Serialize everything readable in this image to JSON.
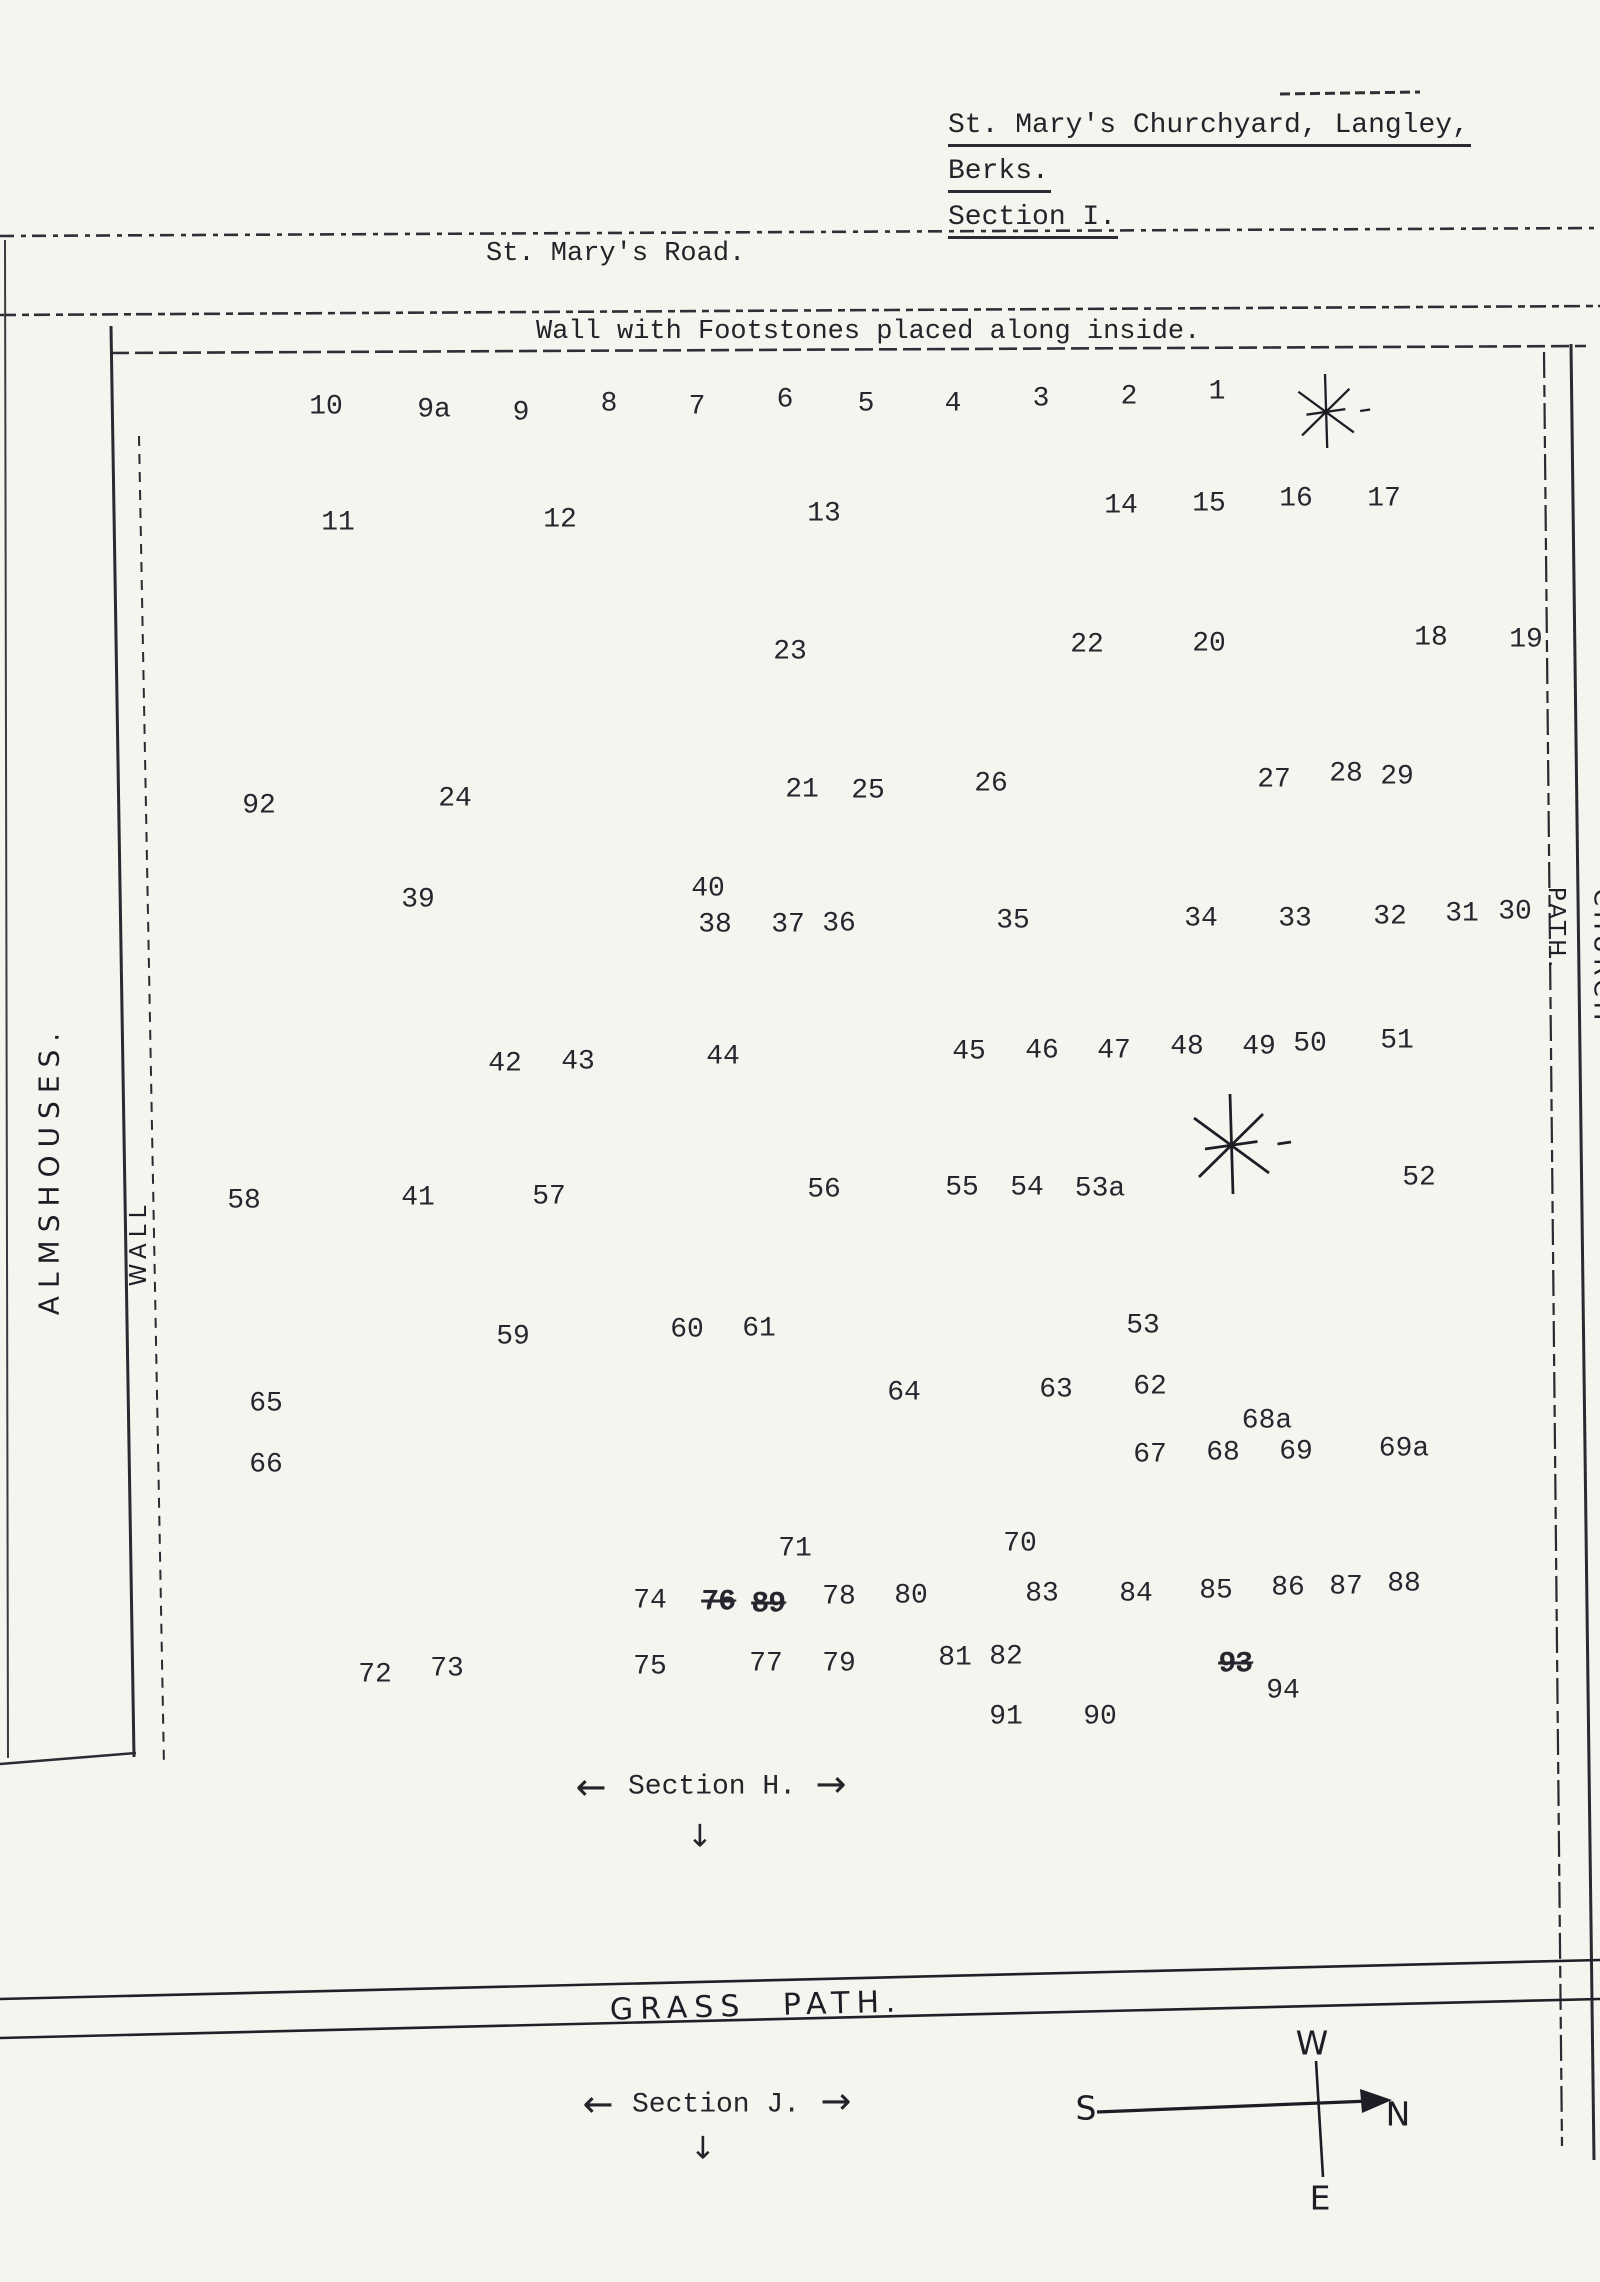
{
  "paper_color": "#f5f4ee",
  "ink_color": "#23232a",
  "title": {
    "lines": [
      "St. Mary's Churchyard, Langley,",
      "Berks.",
      "Section I."
    ]
  },
  "road_label": "St. Mary's Road.",
  "wall_label": "Wall with Footstones placed along inside.",
  "side_labels": {
    "almshouses": "ALMSHOUSES.",
    "wall": "WALL",
    "path": "PATH.",
    "church": "CHURCH"
  },
  "grass_path_label": "GRASS PATH.",
  "glyphs": {
    "arrow_left": "←",
    "arrow_right": "→",
    "arrow_down": "↓"
  },
  "sections": [
    {
      "label": "Section H.",
      "lx": 591,
      "ly": 1787,
      "cx": 712,
      "cy": 1787,
      "rx": 831,
      "ry": 1784,
      "dx": 700,
      "dy": 1837
    },
    {
      "label": "Section J.",
      "lx": 598,
      "ly": 2104,
      "cx": 716,
      "cy": 2105,
      "rx": 836,
      "ry": 2101,
      "dx": 703,
      "dy": 2149
    }
  ],
  "compass": {
    "letters": [
      {
        "t": "W",
        "x": 1312,
        "y": 2043
      },
      {
        "t": "S",
        "x": 1086,
        "y": 2108
      },
      {
        "t": "N",
        "x": 1398,
        "y": 2114
      },
      {
        "t": "E",
        "x": 1320,
        "y": 2198
      }
    ]
  },
  "trees": [
    {
      "x": 1325,
      "y": 411,
      "r": 37
    },
    {
      "x": 1230,
      "y": 1144,
      "r": 50
    }
  ],
  "plots": [
    {
      "n": "10",
      "x": 326,
      "y": 407
    },
    {
      "n": "9a",
      "x": 434,
      "y": 410
    },
    {
      "n": "9",
      "x": 521,
      "y": 413
    },
    {
      "n": "8",
      "x": 609,
      "y": 404
    },
    {
      "n": "7",
      "x": 697,
      "y": 407
    },
    {
      "n": "6",
      "x": 785,
      "y": 400
    },
    {
      "n": "5",
      "x": 866,
      "y": 404
    },
    {
      "n": "4",
      "x": 953,
      "y": 404
    },
    {
      "n": "3",
      "x": 1041,
      "y": 399
    },
    {
      "n": "2",
      "x": 1129,
      "y": 397
    },
    {
      "n": "1",
      "x": 1217,
      "y": 392
    },
    {
      "n": "11",
      "x": 338,
      "y": 523
    },
    {
      "n": "12",
      "x": 560,
      "y": 520
    },
    {
      "n": "13",
      "x": 824,
      "y": 514
    },
    {
      "n": "14",
      "x": 1121,
      "y": 506
    },
    {
      "n": "15",
      "x": 1209,
      "y": 504
    },
    {
      "n": "16",
      "x": 1296,
      "y": 499
    },
    {
      "n": "17",
      "x": 1384,
      "y": 499
    },
    {
      "n": "23",
      "x": 790,
      "y": 652
    },
    {
      "n": "22",
      "x": 1087,
      "y": 645
    },
    {
      "n": "20",
      "x": 1209,
      "y": 644
    },
    {
      "n": "18",
      "x": 1431,
      "y": 638
    },
    {
      "n": "19",
      "x": 1526,
      "y": 640
    },
    {
      "n": "92",
      "x": 259,
      "y": 806
    },
    {
      "n": "24",
      "x": 455,
      "y": 799
    },
    {
      "n": "21",
      "x": 802,
      "y": 790
    },
    {
      "n": "25",
      "x": 868,
      "y": 791
    },
    {
      "n": "26",
      "x": 991,
      "y": 784
    },
    {
      "n": "27",
      "x": 1274,
      "y": 780
    },
    {
      "n": "28",
      "x": 1346,
      "y": 774
    },
    {
      "n": "29",
      "x": 1397,
      "y": 777
    },
    {
      "n": "39",
      "x": 418,
      "y": 900
    },
    {
      "n": "40",
      "x": 708,
      "y": 889
    },
    {
      "n": "38",
      "x": 715,
      "y": 925
    },
    {
      "n": "37",
      "x": 788,
      "y": 925
    },
    {
      "n": "36",
      "x": 839,
      "y": 924
    },
    {
      "n": "35",
      "x": 1013,
      "y": 921
    },
    {
      "n": "34",
      "x": 1201,
      "y": 919
    },
    {
      "n": "33",
      "x": 1295,
      "y": 919
    },
    {
      "n": "32",
      "x": 1390,
      "y": 917
    },
    {
      "n": "31",
      "x": 1462,
      "y": 914
    },
    {
      "n": "30",
      "x": 1515,
      "y": 912
    },
    {
      "n": "42",
      "x": 505,
      "y": 1064
    },
    {
      "n": "43",
      "x": 578,
      "y": 1062
    },
    {
      "n": "44",
      "x": 723,
      "y": 1057
    },
    {
      "n": "45",
      "x": 969,
      "y": 1052
    },
    {
      "n": "46",
      "x": 1042,
      "y": 1051
    },
    {
      "n": "47",
      "x": 1114,
      "y": 1051
    },
    {
      "n": "48",
      "x": 1187,
      "y": 1047
    },
    {
      "n": "49",
      "x": 1259,
      "y": 1047
    },
    {
      "n": "50",
      "x": 1310,
      "y": 1044
    },
    {
      "n": "51",
      "x": 1397,
      "y": 1041
    },
    {
      "n": "58",
      "x": 244,
      "y": 1201
    },
    {
      "n": "41",
      "x": 418,
      "y": 1198
    },
    {
      "n": "57",
      "x": 549,
      "y": 1197
    },
    {
      "n": "56",
      "x": 824,
      "y": 1190
    },
    {
      "n": "55",
      "x": 962,
      "y": 1188
    },
    {
      "n": "54",
      "x": 1027,
      "y": 1188
    },
    {
      "n": "53a",
      "x": 1100,
      "y": 1189
    },
    {
      "n": "52",
      "x": 1419,
      "y": 1178
    },
    {
      "n": "59",
      "x": 513,
      "y": 1337
    },
    {
      "n": "60",
      "x": 687,
      "y": 1330
    },
    {
      "n": "61",
      "x": 759,
      "y": 1329
    },
    {
      "n": "53",
      "x": 1143,
      "y": 1326
    },
    {
      "n": "65",
      "x": 266,
      "y": 1404
    },
    {
      "n": "64",
      "x": 904,
      "y": 1393
    },
    {
      "n": "63",
      "x": 1056,
      "y": 1390
    },
    {
      "n": "62",
      "x": 1150,
      "y": 1387
    },
    {
      "n": "68a",
      "x": 1267,
      "y": 1421
    },
    {
      "n": "66",
      "x": 266,
      "y": 1465
    },
    {
      "n": "67",
      "x": 1150,
      "y": 1455
    },
    {
      "n": "68",
      "x": 1223,
      "y": 1453
    },
    {
      "n": "69",
      "x": 1296,
      "y": 1452
    },
    {
      "n": "69a",
      "x": 1404,
      "y": 1449
    },
    {
      "n": "71",
      "x": 795,
      "y": 1549
    },
    {
      "n": "70",
      "x": 1020,
      "y": 1544
    },
    {
      "n": "74",
      "x": 650,
      "y": 1601
    },
    {
      "n": "76",
      "x": 718,
      "y": 1602,
      "struck": true
    },
    {
      "n": "89",
      "x": 768,
      "y": 1604,
      "struck": true
    },
    {
      "n": "78",
      "x": 839,
      "y": 1597
    },
    {
      "n": "80",
      "x": 911,
      "y": 1596
    },
    {
      "n": "83",
      "x": 1042,
      "y": 1594
    },
    {
      "n": "84",
      "x": 1136,
      "y": 1594
    },
    {
      "n": "85",
      "x": 1216,
      "y": 1591
    },
    {
      "n": "86",
      "x": 1288,
      "y": 1588
    },
    {
      "n": "87",
      "x": 1346,
      "y": 1587
    },
    {
      "n": "88",
      "x": 1404,
      "y": 1584
    },
    {
      "n": "72",
      "x": 375,
      "y": 1675
    },
    {
      "n": "73",
      "x": 447,
      "y": 1669
    },
    {
      "n": "75",
      "x": 650,
      "y": 1667
    },
    {
      "n": "77",
      "x": 766,
      "y": 1664
    },
    {
      "n": "79",
      "x": 839,
      "y": 1664
    },
    {
      "n": "81",
      "x": 955,
      "y": 1658
    },
    {
      "n": "82",
      "x": 1006,
      "y": 1657
    },
    {
      "n": "93",
      "x": 1235,
      "y": 1664,
      "struck": true
    },
    {
      "n": "94",
      "x": 1283,
      "y": 1691
    },
    {
      "n": "91",
      "x": 1006,
      "y": 1717
    },
    {
      "n": "90",
      "x": 1100,
      "y": 1717
    }
  ]
}
